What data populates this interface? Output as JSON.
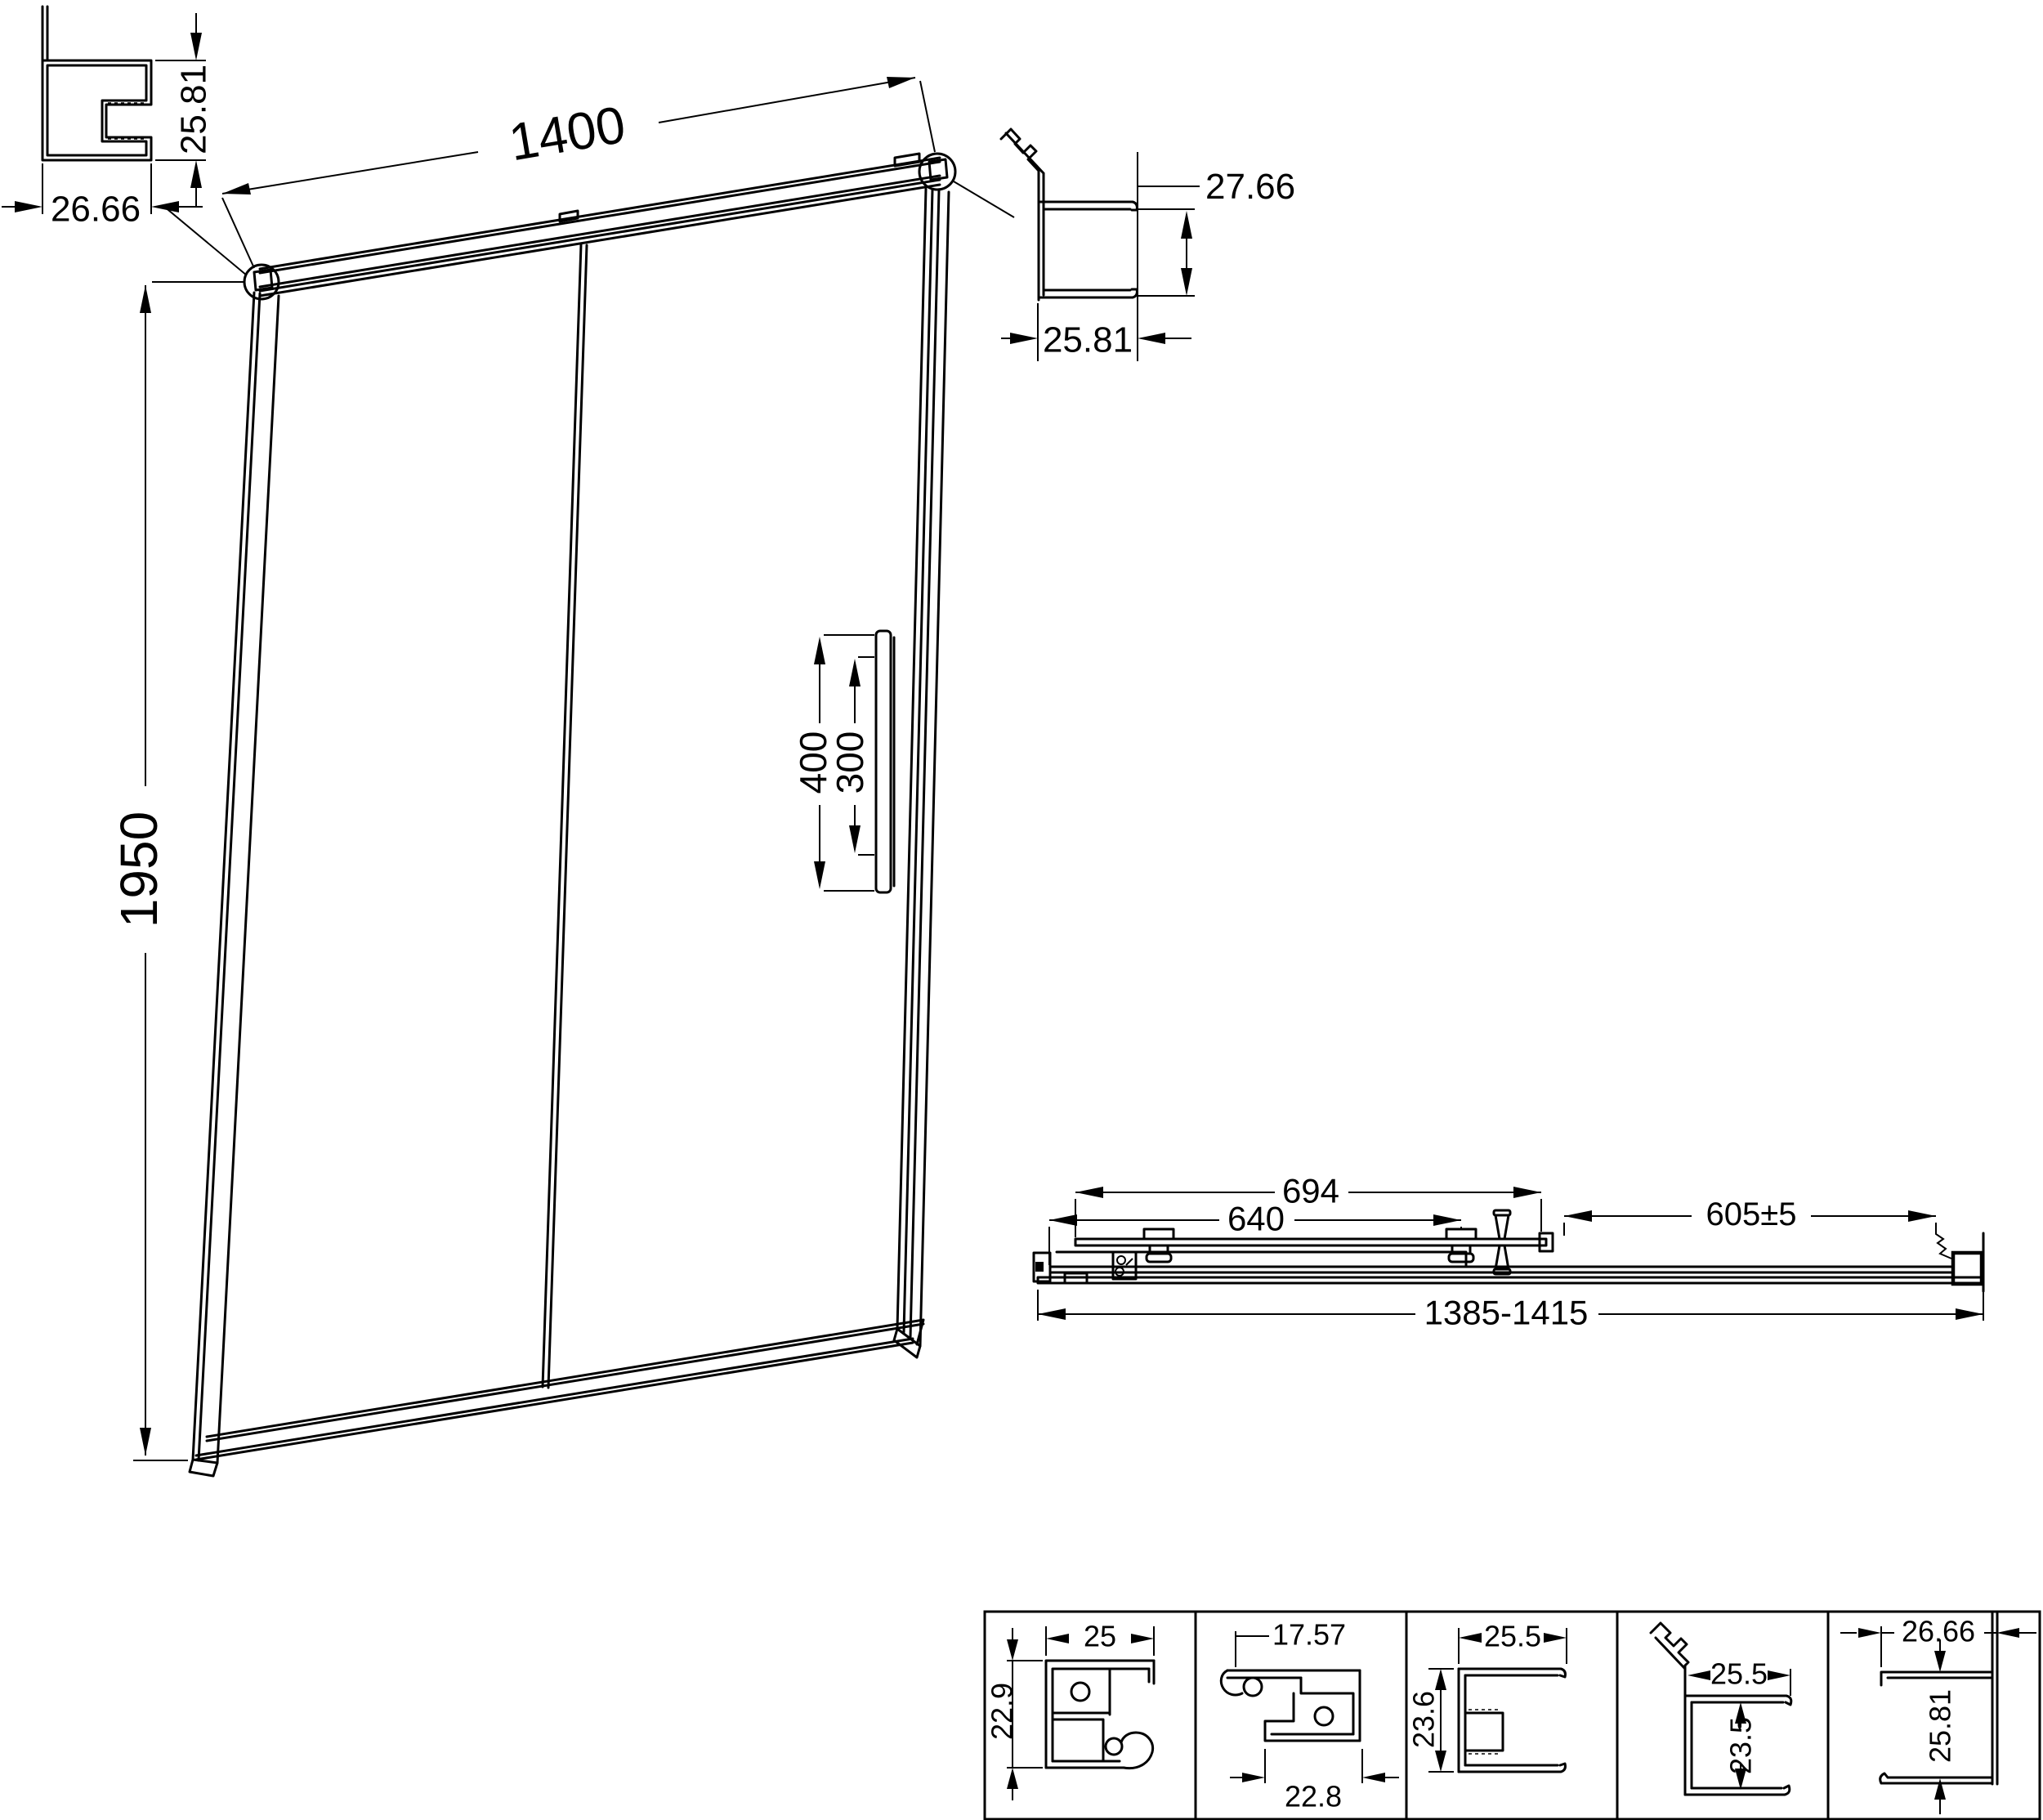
{
  "colors": {
    "line": "#000000",
    "background": "#ffffff"
  },
  "elevation": {
    "width": "1400",
    "height": "1950",
    "handle_length": "400",
    "handle_hole_spacing": "300"
  },
  "top_left_profile": {
    "width": "26.66",
    "height": "25.81"
  },
  "top_right_profile": {
    "height": "27.66",
    "width": "25.81"
  },
  "plan_view": {
    "door_panel_overall": "694",
    "door_glass_width": "640",
    "fixed_panel_width": "605±5",
    "overall_adjustment_range": "1385-1415"
  },
  "details": [
    {
      "dim_top": "25",
      "dim_side": "22.9"
    },
    {
      "dim_top": "17.57",
      "dim_side": "22.8"
    },
    {
      "dim_top": "25.5",
      "dim_side": "23.6"
    },
    {
      "dim_top": "25.5",
      "dim_side": "23.5"
    },
    {
      "dim_top": "26.66",
      "dim_side": "25.81"
    }
  ]
}
